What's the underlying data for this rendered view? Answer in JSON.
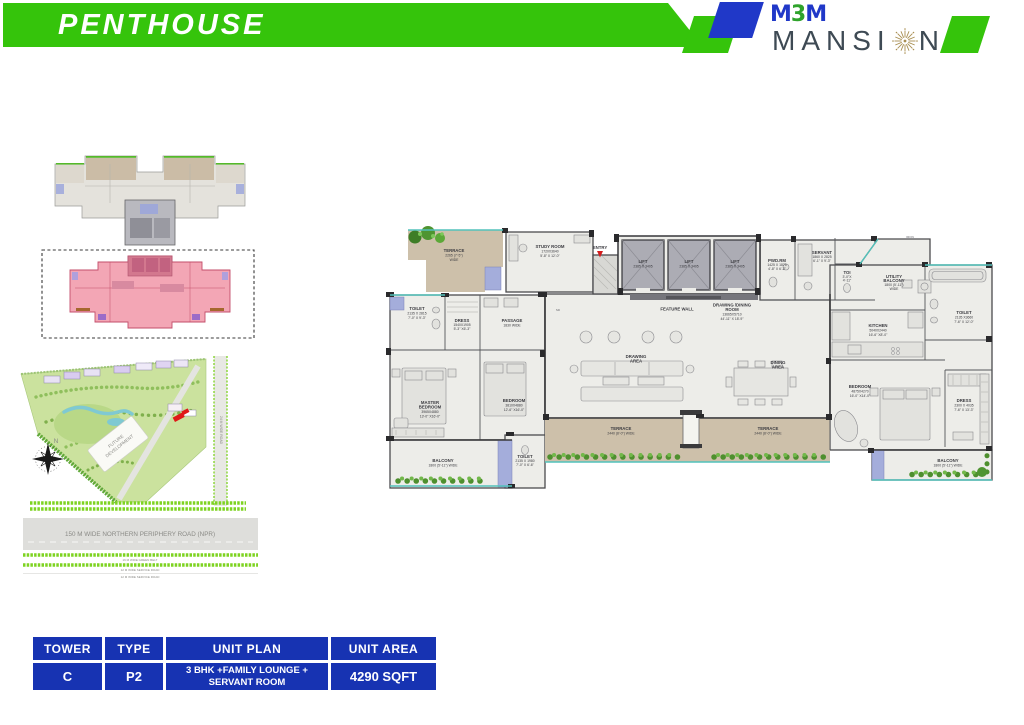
{
  "header": {
    "title": "PENTHOUSE",
    "logo": {
      "m1": "M",
      "three": "3",
      "m2": "M",
      "mansion_pre": "MANSI",
      "mansion_post": "N"
    }
  },
  "site_map": {
    "future_development_line1": "FUTURE",
    "future_development_line2": "DEVELOPMENT",
    "side_road": "24 M WIDE ROAD",
    "npr_road": "150 M  WIDE NORTHERN PERIPHERY ROAD (NPR)",
    "green_belt": "16 M WIDE GREEN BELT",
    "service_road_1": "12 M WIDE SERVICE ROAD",
    "service_road_2": "12 M WIDE SERVICE ROAD",
    "north": "N"
  },
  "floor_plan": {
    "entry": "ENTRY",
    "sd": "SD",
    "iron": "IRON",
    "feature_wall": "FEATURE WALL",
    "terrace_tl": [
      "TERRACE",
      "2265 (7'-5\")",
      "WIDE"
    ],
    "study": [
      "STUDY ROOM",
      "1720X3640",
      "5'-8\" X 12'-0\""
    ],
    "lift": [
      "LIFT",
      "2385 X 3405"
    ],
    "drawing_dining": [
      "DRAWING /DINING",
      "ROOM",
      "13665X5710",
      "44'-11\" X 18'-9\""
    ],
    "pwd": [
      "PWD.RM",
      "1425 X 1875",
      "4'-8\" X 6'-2\""
    ],
    "servant": [
      "SERVANT",
      "1860 X 2825",
      "6'-1\" X 9'-3\""
    ],
    "toi": [
      "TOI",
      "3'-0\"X",
      "4'-11\""
    ],
    "utility_balcony": [
      "UTILITY",
      "BALCONY",
      "1800 (5'-11\")",
      "WIDE"
    ],
    "kitchen": [
      "KITCHEN",
      "5040X2440",
      "16'-6\" X8'-0\""
    ],
    "toilet_tr": [
      "TOILET",
      "2135 X3660",
      "7'-6\" X 12'-0\""
    ],
    "toilet_tl": [
      "TOILET",
      "2135 X 2815",
      "7'-0\" X 9'-3\""
    ],
    "dress_l": [
      "DRESS",
      "1540X1905",
      "5'-3\" X6'-3\""
    ],
    "passage": [
      "PASSAGE",
      "1830 WIDE"
    ],
    "master_bedroom": [
      "MASTER",
      "BEDROOM",
      "3965X4880",
      "13'-0\" X16'-0\""
    ],
    "bedroom_l": [
      "BEDROOM",
      "3810X4880",
      "12'-6\" X16'-0\""
    ],
    "drawing_area": [
      "DRAWING",
      "AREA"
    ],
    "dining_area": [
      "DINING",
      "AREA"
    ],
    "bedroom_r": [
      "BEDROOM",
      "4875X4270",
      "16'-0\" X14'-0\""
    ],
    "dress_r": [
      "DRESS",
      "2300 X 4035",
      "7'-6\" X 13'-3\""
    ],
    "terrace_cl": [
      "TERRACE",
      "2440 (8'-0\") WIDE"
    ],
    "terrace_cr": [
      "TERRACE",
      "2440 (8'-0\") WIDE"
    ],
    "balcony_bl": [
      "BALCONY",
      "1800 (5'-11\") WIDE"
    ],
    "toilet_bl": [
      "TOILET",
      "2135 X 1980",
      "7'-0\" X 6'-6\""
    ],
    "balcony_br": [
      "BALCONY",
      "1800 (5'-11\") WIDE"
    ]
  },
  "table": {
    "headers": [
      "TOWER",
      "TYPE",
      "UNIT PLAN",
      "UNIT AREA"
    ],
    "row": {
      "tower": "C",
      "type": "P2",
      "unit_plan_line1": "3 BHK +FAMILY LOUNGE +",
      "unit_plan_line2": "SERVANT ROOM",
      "unit_area": "4290 SQFT"
    }
  },
  "colors": {
    "banner_green": "#35C40B",
    "logo_blue": "#2038C8",
    "mansion_gray": "#3E4A54",
    "starburst_gold": "#A98F52",
    "table_blue": "#1733B2",
    "highlight_pink": "#F3A6B5",
    "terrace_tan": "#CDC0AA",
    "teal_accent": "#52C2BB"
  }
}
